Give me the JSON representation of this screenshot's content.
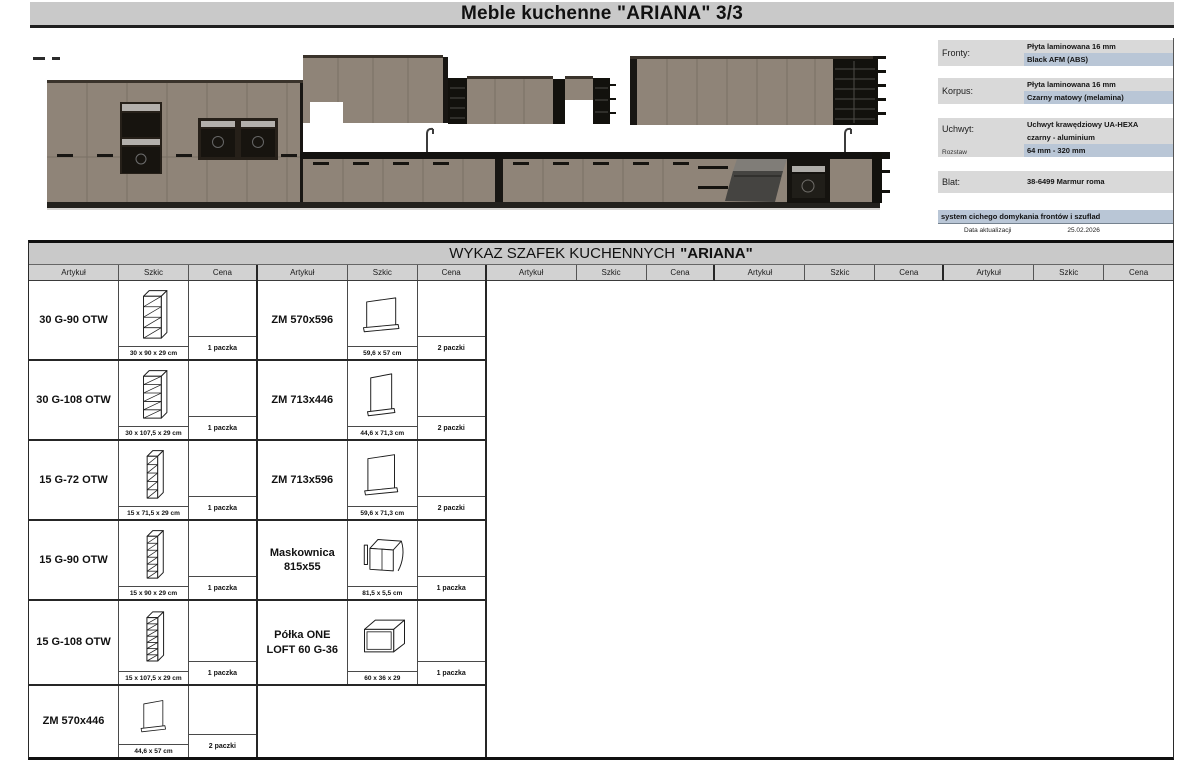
{
  "page_title": "Meble kuchenne \"ARIANA\" 3/3",
  "specs": {
    "blocks": [
      {
        "label": "Fronty:",
        "lines": [
          {
            "text": "Płyta laminowana 16 mm",
            "highlight": false
          },
          {
            "text": "Black AFM (ABS)",
            "highlight": true
          }
        ]
      },
      {
        "label": "Korpus:",
        "lines": [
          {
            "text": "Płyta laminowana 16 mm",
            "highlight": false
          },
          {
            "text": "Czarny matowy (melamina)",
            "highlight": true
          }
        ]
      },
      {
        "label": "Uchwyt:",
        "sublabel": "Rozstaw",
        "lines": [
          {
            "text": "Uchwyt krawędziowy UA-HEXA",
            "highlight": false
          },
          {
            "text": "czarny - aluminium",
            "highlight": false
          },
          {
            "text": "64 mm - 320 mm",
            "highlight": true
          }
        ]
      },
      {
        "label": "Blat:",
        "lines": [
          {
            "text": "38-6499 Marmur roma",
            "highlight": false
          }
        ]
      }
    ],
    "note": "system cichego domykania frontów i szuflad",
    "update_label": "Data aktualizacji",
    "update_date": "25.02.2026"
  },
  "catalog": {
    "heading_normal": "WYKAZ SZAFEK KUCHENNYCH",
    "heading_bold": "\"ARIANA\"",
    "columns": [
      "Artykuł",
      "Szkic",
      "Cena"
    ],
    "groups": [
      {
        "rows": [
          {
            "name": "30 G-90 OTW",
            "sketch": "open-shelf-cabinet-4",
            "dim": "30 x 90 x 29 cm",
            "pack": "1 paczka"
          },
          {
            "name": "30 G-108 OTW",
            "sketch": "open-shelf-cabinet-5",
            "dim": "30 x 107,5 x 29 cm",
            "pack": "1 paczka"
          },
          {
            "name": "15 G-72 OTW",
            "sketch": "open-shelf-narrow-5",
            "dim": "15 x 71,5 x 29 cm",
            "pack": "1 paczka"
          },
          {
            "name": "15 G-90 OTW",
            "sketch": "open-shelf-narrow-6",
            "dim": "15 x 90 x 29 cm",
            "pack": "1 paczka"
          },
          {
            "name": "15 G-108 OTW",
            "sketch": "open-shelf-narrow-7",
            "dim": "15 x 107,5 x 29 cm",
            "pack": "1 paczka"
          },
          {
            "name": "ZM 570x446",
            "sketch": "dishwasher-panel-570x446",
            "dim": "44,6 x 57 cm",
            "pack": "2 paczki"
          }
        ]
      },
      {
        "rows": [
          {
            "name": "ZM 570x596",
            "sketch": "dishwasher-panel-570x596",
            "dim": "59,6 x 57 cm",
            "pack": "2 paczki"
          },
          {
            "name": "ZM 713x446",
            "sketch": "dishwasher-panel-713x446",
            "dim": "44,6 x 71,3 cm",
            "pack": "2 paczki"
          },
          {
            "name": "ZM 713x596",
            "sketch": "dishwasher-panel-713x596",
            "dim": "59,6 x 71,3 cm",
            "pack": "2 paczki"
          },
          {
            "name": "Maskownica 815x55",
            "sketch": "cover-panel-815x55",
            "dim": "81,5 x 5,5 cm",
            "pack": "1 paczka"
          },
          {
            "name": "Półka ONE LOFT 60 G-36",
            "sketch": "open-box-shelf",
            "dim": "60 x 36 x 29",
            "pack": "1 paczka"
          }
        ]
      },
      {
        "rows": []
      },
      {
        "rows": []
      },
      {
        "rows": []
      }
    ]
  },
  "colors": {
    "cabinet_front": "#8f8478",
    "cabinet_dark": "#181613",
    "countertop_black": "#131210",
    "highlight_blue": "#b9c6d6",
    "header_gray": "#c9c9c9",
    "steel": "#b3b0ac"
  }
}
